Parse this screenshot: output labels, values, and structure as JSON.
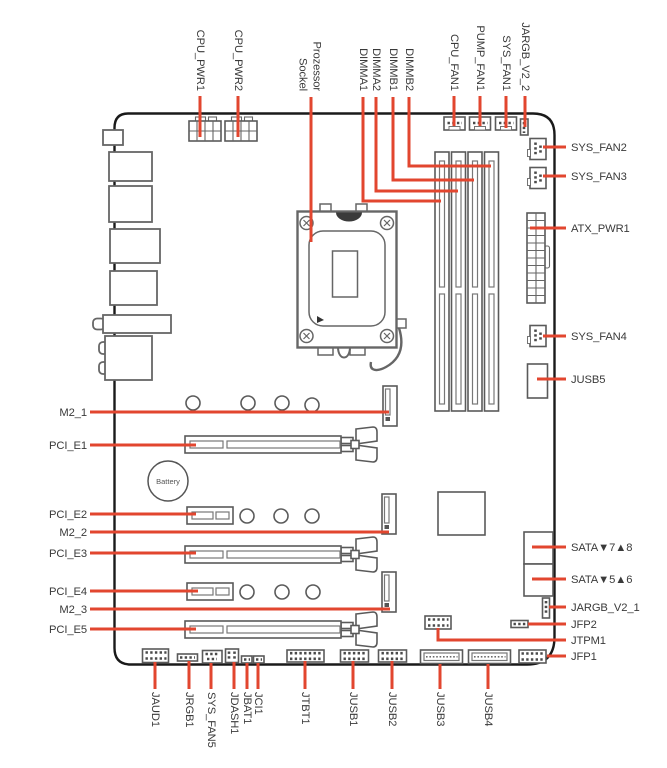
{
  "diagram": {
    "top_labels": {
      "cpu_pwr1": "CPU_PWR1",
      "cpu_pwr2": "CPU_PWR2",
      "socket_line1": "Prozessor",
      "socket_line2": "Sockel",
      "dimma1": "DIMMA1",
      "dimma2": "DIMMA2",
      "dimmb1": "DIMMB1",
      "dimmb2": "DIMMB2",
      "cpu_fan1": "CPU_FAN1",
      "pump_fan1": "PUMP_FAN1",
      "sys_fan1": "SYS_FAN1",
      "jargb_v2_2": "JARGB_V2_2"
    },
    "right_labels": {
      "sys_fan2": "SYS_FAN2",
      "sys_fan3": "SYS_FAN3",
      "atx_pwr1": "ATX_PWR1",
      "sys_fan4": "SYS_FAN4",
      "jusb5": "JUSB5",
      "sata_7_8": "SATA▼7▲8",
      "sata_5_6": "SATA▼5▲6",
      "jargb_v2_1": "JARGB_V2_1",
      "jfp2": "JFP2",
      "jtpm1": "JTPM1",
      "jfp1": "JFP1"
    },
    "left_labels": {
      "m2_1": "M2_1",
      "pci_e1": "PCI_E1",
      "pci_e2": "PCI_E2",
      "m2_2": "M2_2",
      "pci_e3": "PCI_E3",
      "pci_e4": "PCI_E4",
      "m2_3": "M2_3",
      "pci_e5": "PCI_E5"
    },
    "bottom_labels": {
      "jaud1": "JAUD1",
      "jrgb1": "JRGB1",
      "sys_fan5": "SYS_FAN5",
      "jdash1": "JDASH1",
      "jbat1": "JBAT1",
      "jci1": "JCI1",
      "jtbt1": "JTBT1",
      "jusb1": "JUSB1",
      "jusb2": "JUSB2",
      "jusb3": "JUSB3",
      "jusb4": "JUSB4"
    },
    "battery_label": "Battery"
  },
  "colors": {
    "line_red": "#e2462f",
    "text": "#3a3a3a",
    "board_outline": "#1a1a1a"
  }
}
